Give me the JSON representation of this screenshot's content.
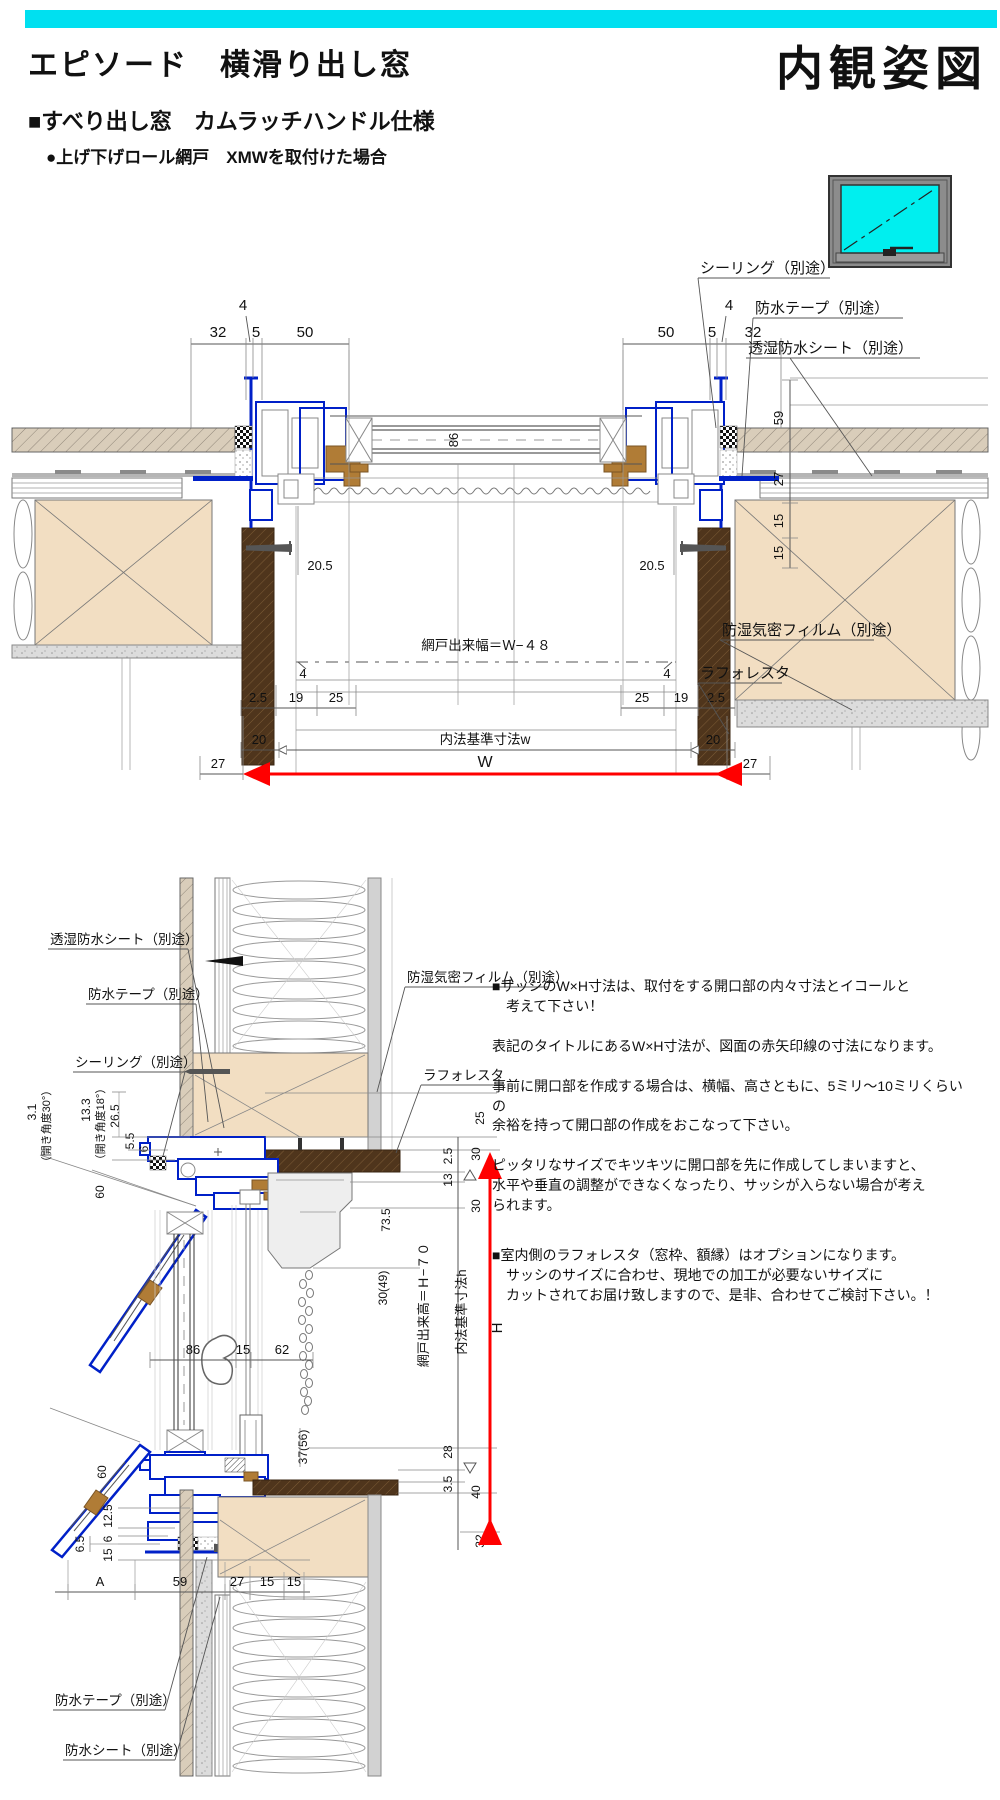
{
  "header": {
    "product_title": "エピソード　横滑り出し窓",
    "view_title": "内観姿図",
    "spec_title": "■すべり出し窓　カムラッチハンドル仕様",
    "option_note": "●上げ下げロール網戸　XMWを取付けた場合"
  },
  "colors": {
    "accent_bar": "#00E0F0",
    "glass_cyan": "#00EFEF",
    "frame_blue": "#0020C8",
    "wood_dark": "#4F351C",
    "wood_tan": "#F2DEC2",
    "arrow_red": "#FF0000"
  },
  "top_drawing": {
    "gap_left": "4",
    "gap_right": "4",
    "dims_left": [
      "32",
      "5",
      "50"
    ],
    "dims_right": [
      "50",
      "5",
      "32"
    ],
    "glass_depth": "86",
    "depth_dims": [
      "59",
      "27",
      "15",
      "15"
    ],
    "screen_offset_left": "20.5",
    "screen_offset_right": "20.5",
    "screen_gap_left": "4",
    "screen_gap_right": "4",
    "screen_width": "網戸出来幅＝Ｗ−４８",
    "row1_left": [
      "2.5",
      "19",
      "25"
    ],
    "row1_right": [
      "25",
      "19",
      "2.5"
    ],
    "row2": [
      "20",
      "内法基準寸法w",
      "20"
    ],
    "row3": [
      "27",
      "W",
      "27"
    ],
    "callout_sealing": "シーリング（別途）",
    "callout_tape": "防水テープ（別途）",
    "callout_sheet": "透湿防水シート（別途）",
    "callout_film": "防湿気密フィルム（別途）",
    "callout_laforesta": "ラフォレスタ"
  },
  "bottom_drawing": {
    "angle30_value": "3.1",
    "angle30_label": "（開き角度30°）",
    "angle18_value": "13.3",
    "angle18_label": "（開き角度18°）",
    "d_265": "26.5",
    "d_55": "5.5",
    "d_6top": "6",
    "d_60top": "60",
    "d_60bottom": "60",
    "d_125": "12.5",
    "d_65": "6.5",
    "d_6bottom": "6",
    "d_15left": "15",
    "bottom_dims": [
      "A",
      "59",
      "27",
      "15",
      "15"
    ],
    "mid_dims": [
      "86",
      "15",
      "62"
    ],
    "d_25": "25",
    "d_30a": "30",
    "d_25b": "2.5",
    "d_13": "13",
    "d_30b": "30",
    "d_735": "73.5",
    "d_3049": "30(49)",
    "d_3756": "37(56)",
    "d_28": "28",
    "d_35": "3.5",
    "d_40": "40",
    "d_32": "32",
    "screen_height": "網戸出来高＝Ｈ−７０",
    "base_height": "内法基準寸法h",
    "height_mark": "H",
    "callout_sheet": "透湿防水シート（別途）",
    "callout_tape_top": "防水テープ（別途）",
    "callout_sealing": "シーリング（別途）",
    "callout_film": "防湿気密フィルム（別途）",
    "callout_laforesta": "ラフォレスタ",
    "callout_tape_bottom": "防水テープ（別途）",
    "callout_sheet_bottom": "防水シート（別途）"
  },
  "notes": {
    "p1": "■サッシのW×H寸法は、取付をする開口部の内々寸法とイコールと\n　考えて下さい！",
    "p2": "表記のタイトルにあるW×H寸法が、図面の赤矢印線の寸法になります。",
    "p3": "事前に開口部を作成する場合は、横幅、高さともに、5ミリ～10ミリくらいの\n余裕を持って開口部の作成をおこなって下さい。",
    "p4": "ピッタリなサイズでキツキツに開口部を先に作成してしまいますと、\n水平や垂直の調整ができなくなったり、サッシが入らない場合が考え\nられます。",
    "p5": "■室内側のラフォレスタ（窓枠、額縁）はオプションになります。\n　サッシのサイズに合わせ、現地での加工が必要ないサイズに\n　カットされてお届け致しますので、是非、合わせてご検討下さい。！"
  }
}
